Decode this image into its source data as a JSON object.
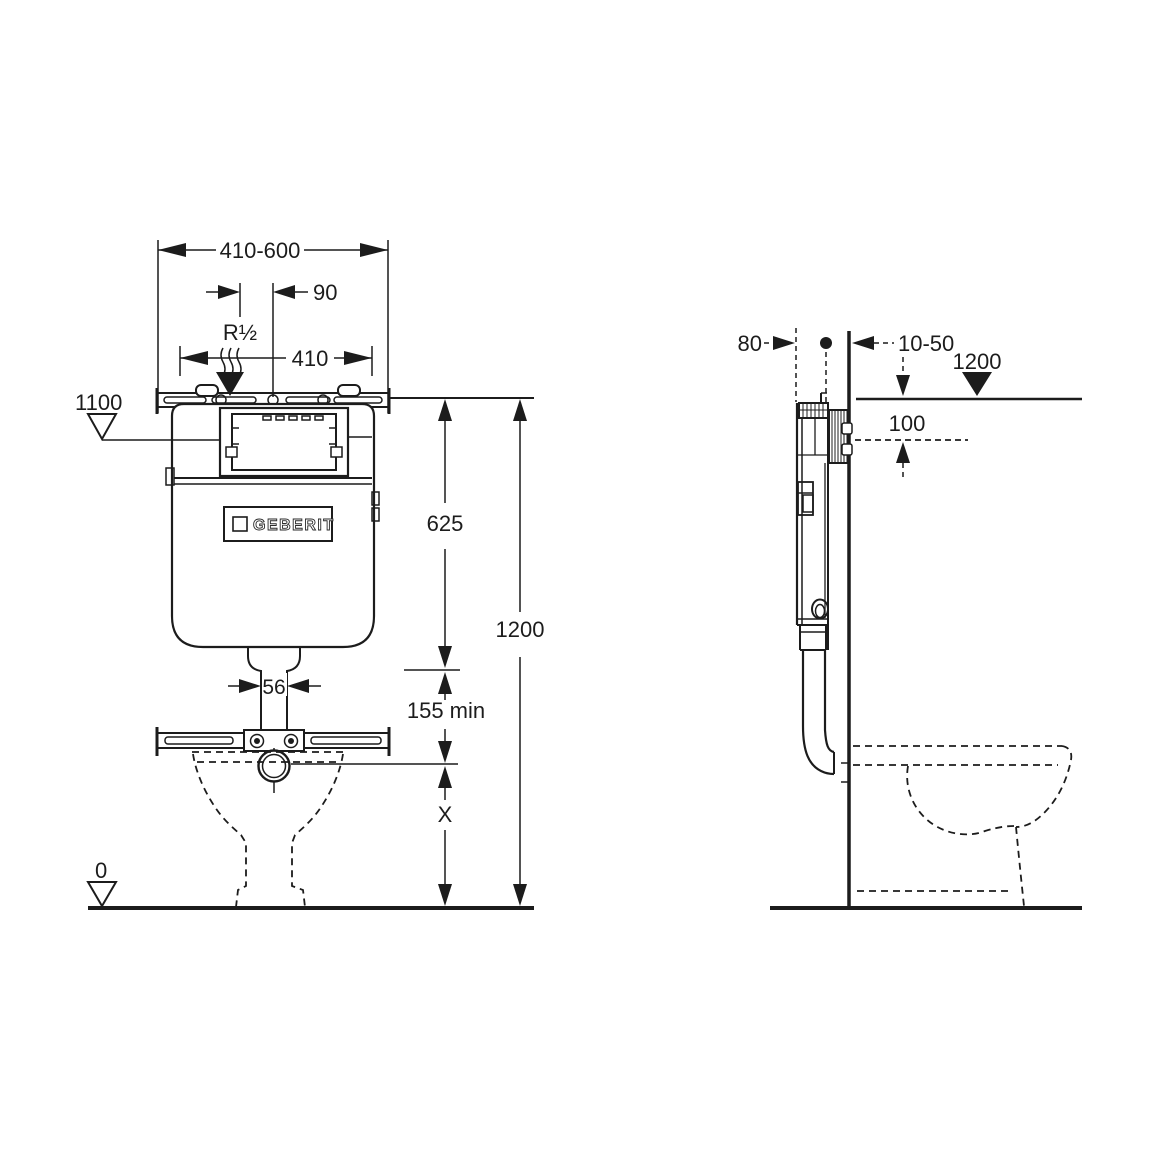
{
  "title": "Concealed cistern installation dimensions",
  "brand": {
    "logo_text": "GEBERIT"
  },
  "front_view": {
    "label_width_range": "410-600",
    "label_offset_90": "90",
    "label_supply_connection": "R½",
    "label_width_410": "410",
    "label_level_1100": "1100",
    "label_cistern_height_625": "625",
    "label_total_height_1200": "1200",
    "label_pipe_width_56": "56",
    "label_min_clearance_155": "155 min",
    "label_variable_x": "X",
    "label_floor_level_0": "0"
  },
  "side_view": {
    "label_depth_80": "80",
    "label_wall_finish_10_50": "10-50",
    "label_level_1200": "1200",
    "label_offset_100": "100"
  },
  "colors": {
    "line": "#1c1c1c",
    "background": "#ffffff"
  }
}
